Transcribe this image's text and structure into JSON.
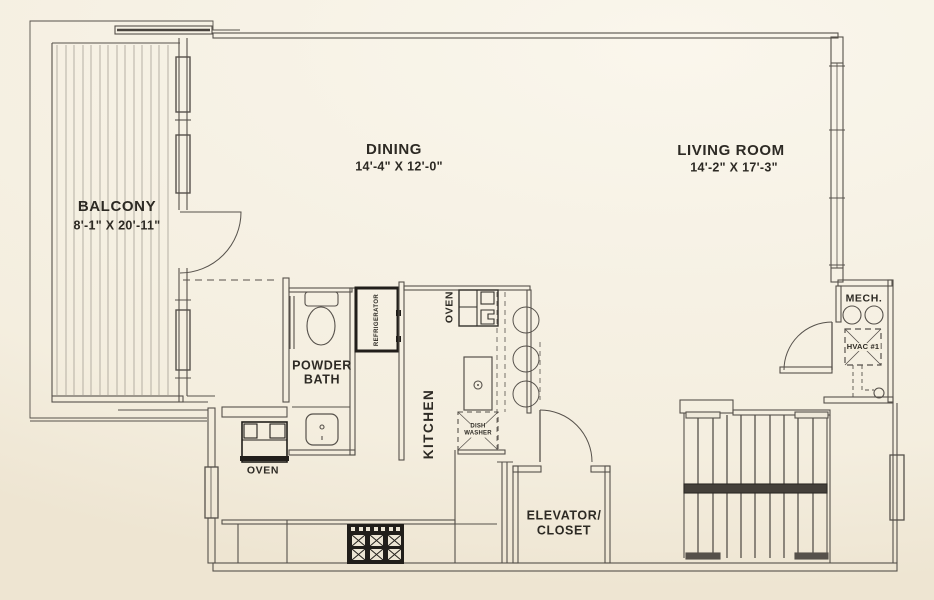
{
  "rooms": {
    "balcony": {
      "name": "BALCONY",
      "dims": "8'-1\" X 20'-11\""
    },
    "dining": {
      "name": "DINING",
      "dims": "14'-4\" X 12'-0\""
    },
    "living_room": {
      "name": "LIVING ROOM",
      "dims": "14'-2\" X 17'-3\""
    },
    "powder_bath": {
      "line1": "POWDER",
      "line2": "BATH"
    },
    "kitchen": {
      "name": "KITCHEN"
    },
    "elevator_closet": {
      "line1": "ELEVATOR/",
      "line2": "CLOSET"
    },
    "mech": {
      "name": "MECH."
    }
  },
  "appliances": {
    "refrigerator": "REFRIGERATOR",
    "oven_kitchen": "OVEN",
    "oven_wall": "OVEN",
    "dishwasher_line1": "DISH",
    "dishwasher_line2": "WASHER",
    "hvac_unit": "HVAC #1"
  },
  "colors": {
    "background": "#f6f1e4",
    "wall_line": "#56514b",
    "dark_line": "#3a3631",
    "text": "#2d2a24",
    "appliance_black": "#211e1a"
  }
}
